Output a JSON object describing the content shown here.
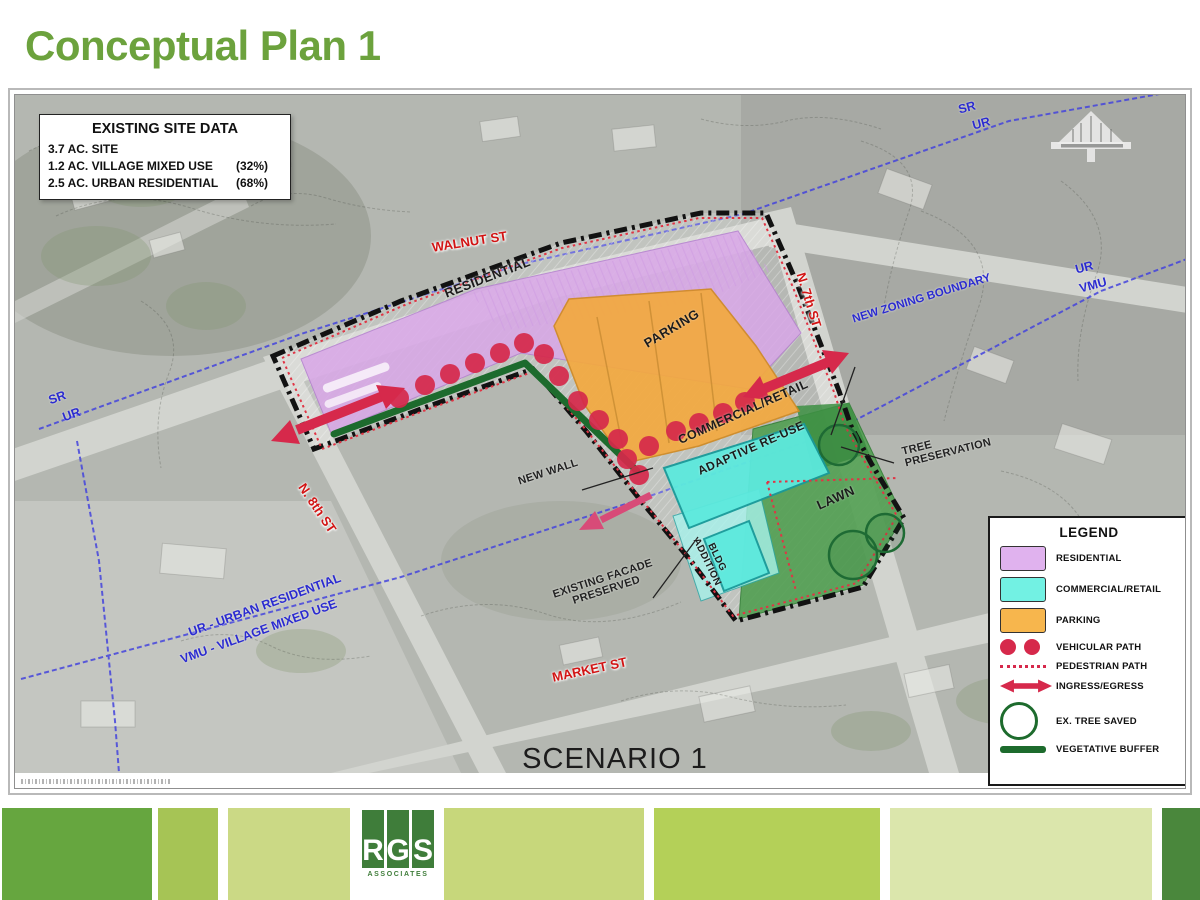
{
  "slide": {
    "title": "Conceptual Plan 1"
  },
  "site_data": {
    "title": "EXISTING SITE DATA",
    "rows": [
      {
        "label": "3.7 AC. SITE",
        "pct": ""
      },
      {
        "label": "1.2 AC. VILLAGE MIXED USE",
        "pct": "(32%)"
      },
      {
        "label": "2.5 AC. URBAN RESIDENTIAL",
        "pct": "(68%)"
      }
    ]
  },
  "map": {
    "streets": {
      "walnut": "WALNUT ST",
      "seventh": "N. 7th ST",
      "eighth": "N. 8th ST",
      "market": "MARKET ST"
    },
    "zoning": {
      "sr_left": "SR",
      "ur_left": "UR",
      "sr_top": "SR",
      "ur_top": "UR",
      "ur_right": "UR",
      "vmu_right": "VMU",
      "new_boundary": "NEW ZONING BOUNDARY",
      "ur_full": "UR - URBAN RESIDENTIAL",
      "vmu_full": "VMU - VILLAGE MIXED USE"
    },
    "zones": {
      "residential": "RESIDENTIAL",
      "parking": "PARKING",
      "commercial": "COMMERCIAL/RETAIL",
      "adaptive": "ADAPTIVE RE-USE",
      "bldg_addition": "BLDG ADDITION",
      "lawn": "LAWN"
    },
    "callouts": {
      "new_wall": "NEW WALL",
      "existing_facade": "EXISTING FACADE PRESERVED",
      "tree_preservation": "TREE PRESERVATION"
    },
    "scenario": "SCENARIO 1"
  },
  "legend": {
    "title": "LEGEND",
    "items": [
      {
        "label": "RESIDENTIAL",
        "type": "swatch",
        "color": "#e0b2ee"
      },
      {
        "label": "COMMERCIAL/RETAIL",
        "type": "swatch",
        "color": "#72f1e3"
      },
      {
        "label": "PARKING",
        "type": "swatch",
        "color": "#f7b64d"
      },
      {
        "label": "VEHICULAR PATH",
        "type": "dots",
        "color": "#d6294b"
      },
      {
        "label": "PEDESTRIAN PATH",
        "type": "dotted-line",
        "color": "#d6294b"
      },
      {
        "label": "INGRESS/EGRESS",
        "type": "double-arrow",
        "color": "#d6294b"
      },
      {
        "label": "EX. TREE SAVED",
        "type": "circle-outline",
        "color": "#1d6b2d"
      },
      {
        "label": "VEGETATIVE BUFFER",
        "type": "thick-line",
        "color": "#1d6b2d"
      }
    ]
  },
  "footer": {
    "logo": {
      "l1": "R",
      "l2": "G",
      "l3": "S",
      "sub": "ASSOCIATES"
    },
    "squares": [
      "#66a63f",
      "#a6c455",
      "#cbd985",
      "#c7d77b",
      "#b4d058",
      "#dbe6ac",
      "#4a873c"
    ]
  },
  "colors": {
    "title_green": "#6ca23d",
    "residential_fill": "#d9a7e8",
    "commercial_fill": "#5ce9dd",
    "parking_fill": "#f3a93f",
    "lawn_green": "#4f9e4f",
    "buffer_green": "#1d6b2d",
    "path_red": "#d6294b",
    "street_red": "#d21414",
    "zoning_blue": "#2b2bd0",
    "magenta_arrow": "#d84b78"
  }
}
